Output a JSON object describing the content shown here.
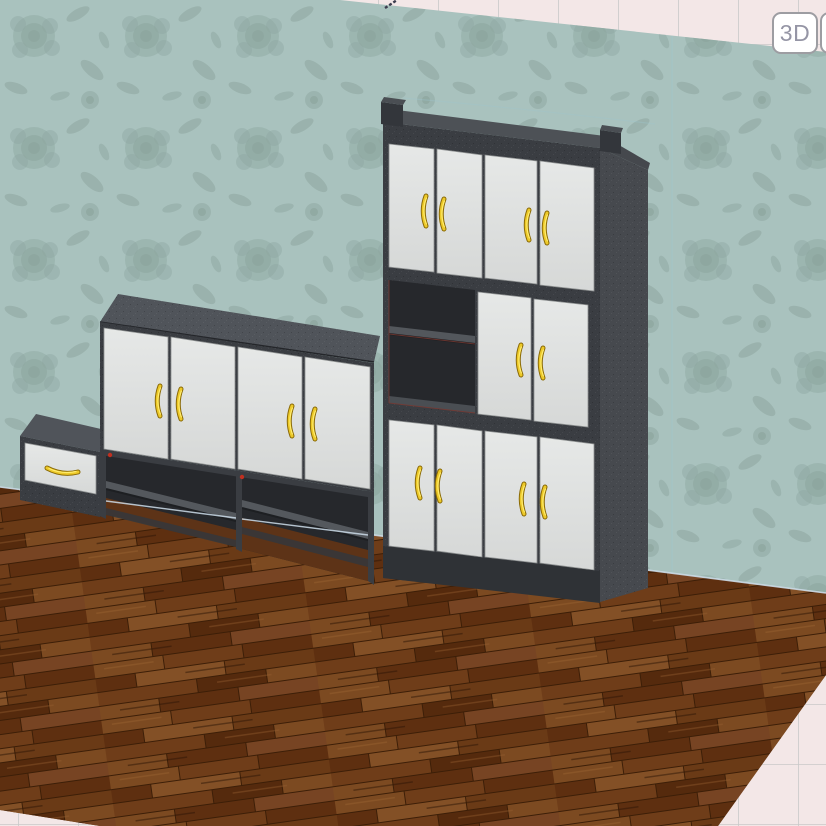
{
  "app": {
    "view_buttons": {
      "mode_3d_label": "3D",
      "partial_label": ""
    }
  },
  "colors": {
    "grid_bg": "#f3e7e7",
    "grid_line": "#c9c9c9",
    "wall_base": "#a9c2be",
    "wall_pattern": "#8da69f",
    "floor_base": "#6e3c18",
    "frame_front": "#3a3d42",
    "frame_top": "#50545a",
    "frame_side": "#46494e",
    "frame_plinth": "#2f3236",
    "interior_shadow": "#26282c",
    "shelf_top": "#54585d",
    "door_face": "#dfe1e0",
    "handle_gold": "#edc928",
    "junction_line": "#cdddea",
    "connector_red": "#c03020",
    "button_border": "#9d9da2",
    "button_text": "#9595a5"
  },
  "scene": {
    "view": "3D room perspective",
    "wall": {
      "finish": "teal floral damask wallpaper"
    },
    "floor": {
      "finish": "dark walnut plank flooring"
    },
    "outside": {
      "type": "plan grid plane",
      "grid_spacing_px": 60
    },
    "furniture": [
      {
        "id": "drawer-unit",
        "type": "low cabinet with single drawer",
        "drawers": 1,
        "handle_style": "horizontal gold bow"
      },
      {
        "id": "sideboard",
        "type": "4-door wall cabinet with open shelf base",
        "doors": 4,
        "handles": 4,
        "open_compartments": 2
      },
      {
        "id": "tall-cabinet",
        "type": "tall wardrobe with open shelf niche",
        "doors": 10,
        "handles": 10,
        "open_compartments": 1
      }
    ]
  }
}
